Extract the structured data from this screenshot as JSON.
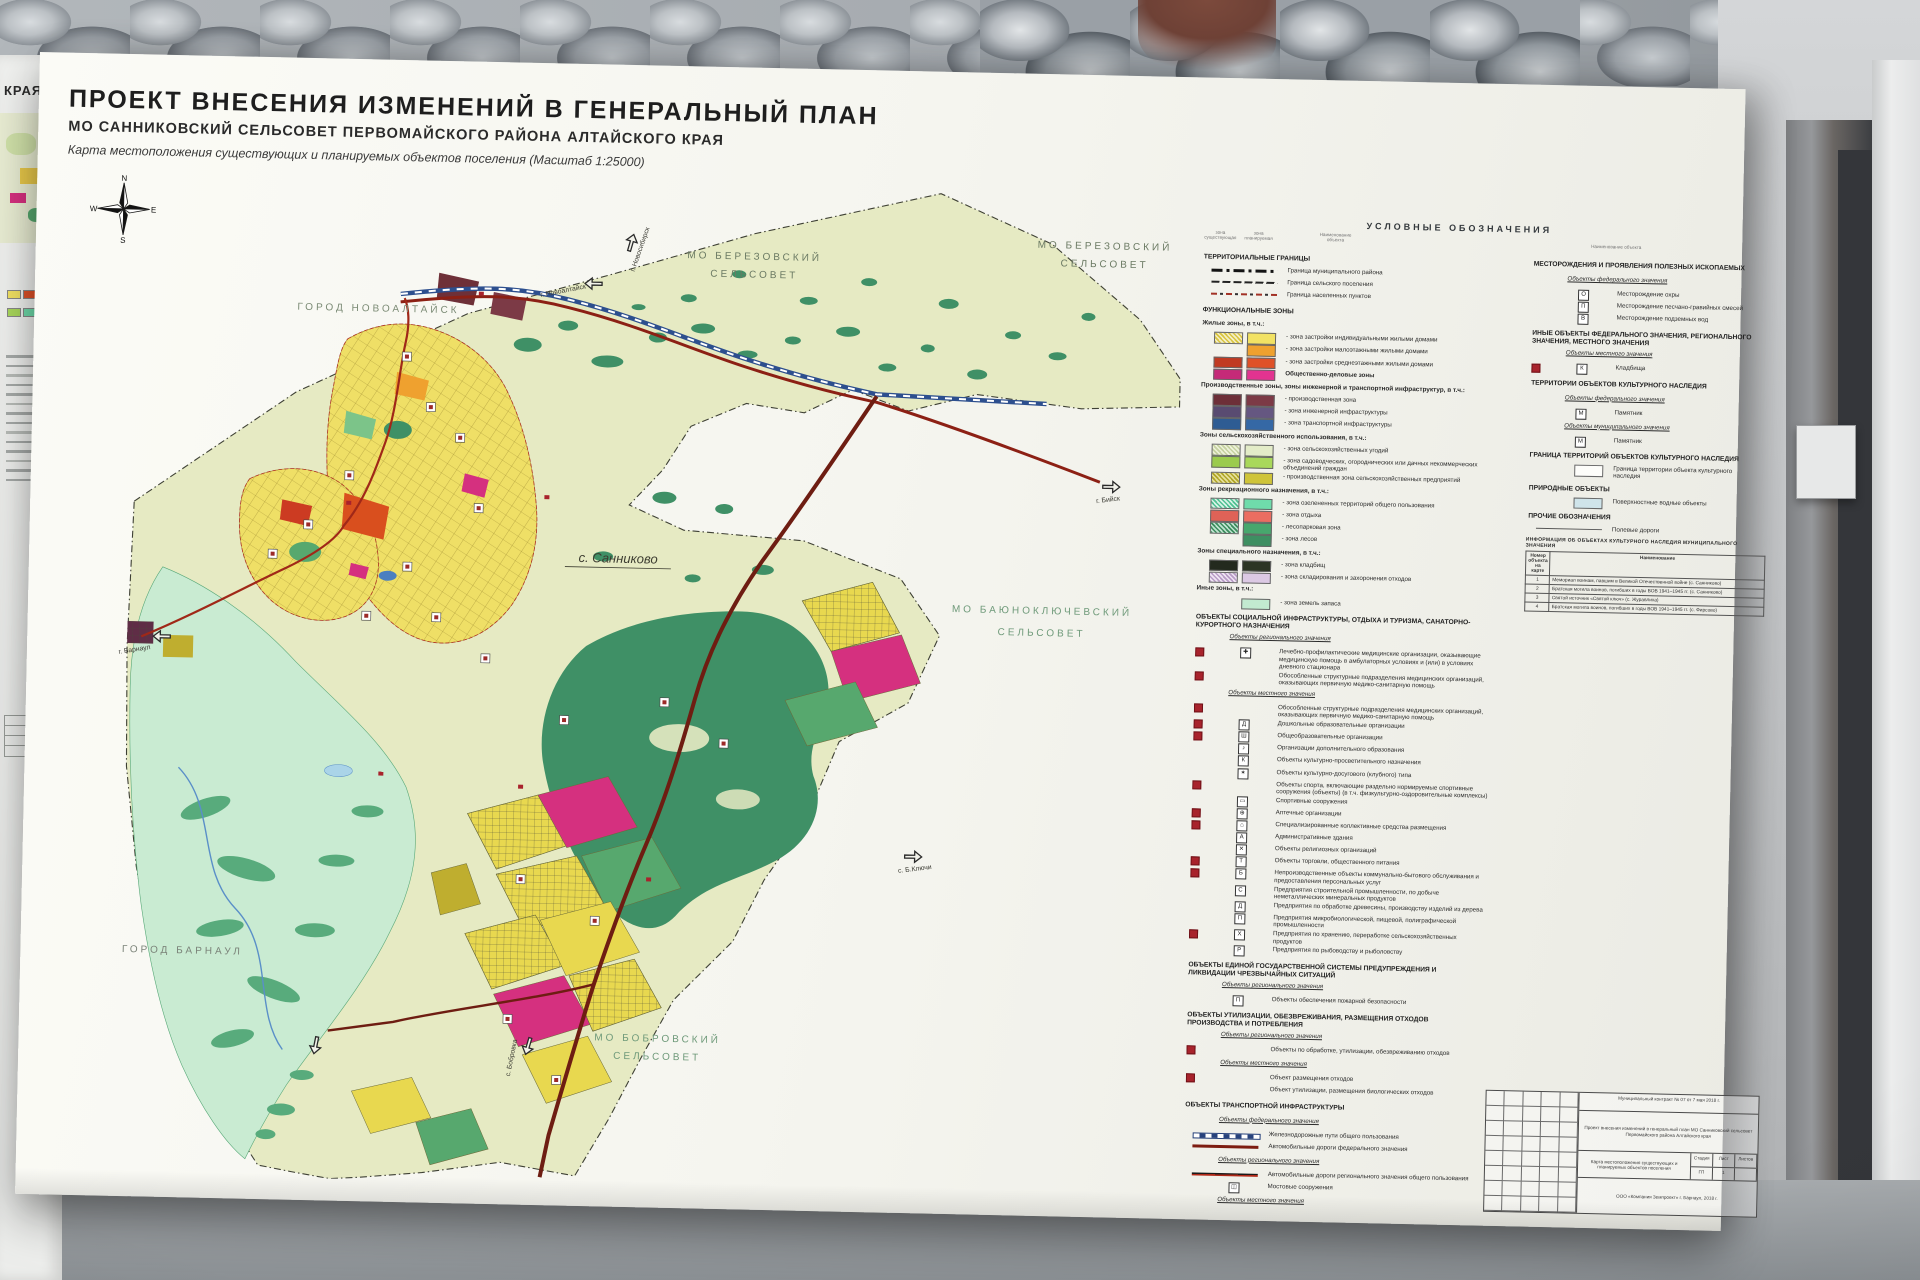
{
  "palette": {
    "paper": "#f6f6f1",
    "territory": "#e6eac3",
    "forest": "#3f9066",
    "floodplain": "#c9ebd2",
    "residential": "#efdf66",
    "public_business": "#e23390",
    "industrial": "#7c3a46",
    "fed_road": "#8c2014",
    "railway": "#2d4f8e",
    "water": "#4a7fc0",
    "planned_marker": "#a8232c"
  },
  "left_poster": {
    "fragment": "КРАЯ"
  },
  "poster": {
    "title": "ПРОЕКТ ВНЕСЕНИЯ ИЗМЕНЕНИЙ В ГЕНЕРАЛЬНЫЙ ПЛАН",
    "subtitle": "МО САННИКОВСКИЙ СЕЛЬСОВЕТ ПЕРВОМАЙСКОГО РАЙОНА АЛТАЙСКОГО КРАЯ",
    "caption": "Карта местоположения существующих и планируемых объектов поселения (Масштаб 1:25000)"
  },
  "compass": {
    "n": "N",
    "w": "W",
    "e": "E",
    "s": "S"
  },
  "map": {
    "labels": {
      "berezovsky1_l1": "МО  БЕРЕЗОВСКИЙ",
      "berezovsky1_l2": "СЕЛЬСОВЕТ",
      "berezovsky2_l1": "МО  БЕРЕЗОВСКИЙ",
      "berezovsky2_l2": "СЕЛЬСОВЕТ",
      "novoaltaysk": "ГОРОД  НОВОАЛТАЙСК",
      "sannikovo": "с. Санниково",
      "bayunokl_l1": "МО  БАЮНОКЛЮЧЕВСКИЙ",
      "bayunokl_l2": "СЕЛЬСОВЕТ",
      "barnaul": "ГОРОД  БАРНАУЛ",
      "bobrovsky_l1": "МО  БОБРОВСКИЙ",
      "bobrovsky_l2": "СЕЛЬСОВЕТ"
    },
    "arrows": {
      "novosibirsk": "г. Новосибирск",
      "novoaltaysk": "г. Новоалтайск",
      "biysk": "г. Бийск",
      "barnaul": "г. Барнаул",
      "bklyuchi": "с. Б.Ключи",
      "bobrovka": "с. Бобровка"
    }
  },
  "legend_title": "УСЛОВНЫЕ ОБОЗНАЧЕНИЯ",
  "legend_cols": {
    "existing": "зона существующая",
    "planned": "зона планируемая",
    "name": "Наименование объекта"
  },
  "legend1": {
    "rows": [
      {
        "cls": "sec",
        "label": "ТЕРРИТОРИАЛЬНЫЕ ГРАНИЦЫ"
      },
      {
        "cls": "item line b-mun",
        "label": "Граница муниципального района"
      },
      {
        "cls": "item line b-set",
        "label": "Граница сельского поселения"
      },
      {
        "cls": "item line b-nas",
        "label": "Граница населенных пунктов"
      },
      {
        "cls": "sec",
        "label": "ФУНКЦИОНАЛЬНЫЕ ЗОНЫ"
      },
      {
        "cls": "zhead",
        "label": "Жилые зоны, в т.ч.:"
      },
      {
        "cls": "item pair",
        "c1": "repeating-linear-gradient(45deg,#d8c43e 0,#d8c43e 1.6px,#f4eec6 1.6px,#f4eec6 3.2px)",
        "c2": "#f2e263",
        "label": "- зона застройки индивидуальными жилыми домами"
      },
      {
        "cls": "item pair",
        "c2": "#efa12f",
        "label": "- зона застройки малоэтажными жилыми домами"
      },
      {
        "cls": "item pair",
        "c1": "#c03a22",
        "c2": "#df5128",
        "label": "- зона застройки среднеэтажными жилыми домами"
      },
      {
        "cls": "item pair zb",
        "c1": "#c52a78",
        "c2": "#e23390",
        "label": "Общественно-деловые зоны"
      },
      {
        "cls": "zhead",
        "label": "Производственные зоны, зоны инженерной и транспортной инфраструктур, в т.ч.:"
      },
      {
        "cls": "item pair",
        "c1": "#6d2f38",
        "c2": "#7c3a46",
        "label": "- производственная зона"
      },
      {
        "cls": "item pair",
        "c1": "#594b71",
        "c2": "#655781",
        "label": "- зона инженерной инфраструктуры"
      },
      {
        "cls": "item pair",
        "c1": "#2e5c93",
        "c2": "#3568a5",
        "label": "- зона транспортной инфраструктуры"
      },
      {
        "cls": "zhead",
        "label": "Зоны сельскохозяйственного использования, в т.ч.:"
      },
      {
        "cls": "item pair",
        "c1": "repeating-linear-gradient(45deg,#c5d1a0 0,#c5d1a0 1.6px,#eef2da 1.6px,#eef2da 3.2px)",
        "c2": "#e3ecc8",
        "label": "- зона сельскохозяйственных угодий"
      },
      {
        "cls": "item pair",
        "c1": "#9bcb4d",
        "c2": "#a9d85b",
        "label": "- зона садоводческих, огороднических или дачных некоммерческих объединений граждан"
      },
      {
        "cls": "item pair",
        "c1": "repeating-linear-gradient(45deg,#b0a527 0,#b0a527 1.6px,#e6e09a 1.6px,#e6e09a 3.2px)",
        "c2": "#cfc439",
        "label": "- производственная зона сельскохозяйственных предприятий"
      },
      {
        "cls": "zhead",
        "label": "Зоны рекреационного назначения, в т.ч.:"
      },
      {
        "cls": "item pair",
        "c1": "repeating-linear-gradient(45deg,#4fc193 0,#4fc193 1.6px,#d7f3e6 1.6px,#d7f3e6 3.2px)",
        "c2": "#6fdcab",
        "label": "- зона озелененных территорий общего пользования"
      },
      {
        "cls": "item pair",
        "c1": "#df6257",
        "c2": "#eb6d61",
        "label": "- зона отдыха"
      },
      {
        "cls": "item pair",
        "c1": "repeating-linear-gradient(45deg,#3c8c5e 0,#3c8c5e 1.6px,#bfe3cf 1.6px,#bfe3cf 3.2px)",
        "c2": "#47a76d",
        "label": "- лесопарковая зона"
      },
      {
        "cls": "item pair",
        "c2": "#3e8f62",
        "label": "- зона лесов"
      },
      {
        "cls": "zhead",
        "label": "Зоны специального назначения, в т.ч.:"
      },
      {
        "cls": "item pair",
        "c1": "#232a1e",
        "c2": "#2c3524",
        "label": "- зона кладбищ"
      },
      {
        "cls": "item pair",
        "c1": "repeating-linear-gradient(45deg,#b89cc6 0,#b89cc6 1.6px,#efe4f3 1.6px,#efe4f3 3.2px)",
        "c2": "#dcc9e4",
        "label": "- зона складирования и захоронения отходов"
      },
      {
        "cls": "zhead",
        "label": "Иные зоны, в т.ч.:"
      },
      {
        "cls": "item pair",
        "c2": "#c2ead0",
        "label": "- зона земель запаса"
      },
      {
        "cls": "sec",
        "label": "ОБЪЕКТЫ СОЦИАЛЬНОЙ ИНФРАСТРУКТУРЫ, ОТДЫХА И ТУРИЗМА, САНАТОРНО-КУРОРТНОГО НАЗНАЧЕНИЯ"
      },
      {
        "cls": "sub",
        "label": "Объекты регионального значения"
      },
      {
        "cls": "item icon red",
        "icon": "✚",
        "label": "Лечебно-профилактические медицинские организации, оказывающие медицинскую помощь в амбулаторных условиях и (или) в условиях дневного стационара"
      },
      {
        "cls": "item red",
        "label": "Обособленные структурные подразделения медицинских организаций, оказывающих первичную медико-санитарную помощь"
      },
      {
        "cls": "sub",
        "label": "Объекты местного значения"
      },
      {
        "cls": "item red",
        "label": "Обособленные структурные подразделения медицинских организаций, оказывающих первичную медико-санитарную помощь"
      },
      {
        "cls": "item icon red",
        "icon": "Д",
        "label": "Дошкольные образовательные организации"
      },
      {
        "cls": "item icon red",
        "icon": "Ш",
        "label": "Общеобразовательные организации"
      },
      {
        "cls": "item icon",
        "icon": "♪",
        "label": "Организации дополнительного образования"
      },
      {
        "cls": "item icon",
        "icon": "К",
        "label": "Объекты культурно-просветительного назначения"
      },
      {
        "cls": "item icon",
        "icon": "✶",
        "label": "Объекты культурно-досугового (клубного) типа"
      },
      {
        "cls": "item red",
        "label": "Объекты спорта, включающие раздельно нормируемые спортивные сооружения (объекты) (в т.ч. физкультурно-оздоровительные комплексы)"
      },
      {
        "cls": "item icon",
        "icon": "▭",
        "label": "Спортивные сооружения"
      },
      {
        "cls": "item icon red",
        "icon": "⊕",
        "label": "Аптечные организации"
      },
      {
        "cls": "item icon red",
        "icon": "⌂",
        "label": "Специализированные коллективные средства размещения"
      },
      {
        "cls": "item icon",
        "icon": "А",
        "label": "Административные здания"
      },
      {
        "cls": "item icon",
        "icon": "✕",
        "label": "Объекты религиозных организаций"
      },
      {
        "cls": "item icon red",
        "icon": "Т",
        "label": "Объекты торговли, общественного питания"
      },
      {
        "cls": "item icon red",
        "icon": "Б",
        "label": "Непроизводственные объекты коммунально-бытового обслуживания и предоставления персональных услуг"
      },
      {
        "cls": "item icon",
        "icon": "С",
        "label": "Предприятия строительной промышленности, по добыче неметаллических минеральных продуктов"
      },
      {
        "cls": "item icon",
        "icon": "Д",
        "label": "Предприятия по обработке древесины, производству изделий из дерева"
      },
      {
        "cls": "item icon",
        "icon": "П",
        "label": "Предприятия микробиологической, пищевой, полиграфической промышленности"
      },
      {
        "cls": "item icon red",
        "icon": "Х",
        "label": "Предприятия по хранению, переработке сельскохозяйственных продуктов"
      },
      {
        "cls": "item icon",
        "icon": "Р",
        "label": "Предприятия по рыбоводству и рыболовству"
      },
      {
        "cls": "sec",
        "label": "ОБЪЕКТЫ ЕДИНОЙ ГОСУДАРСТВЕННОЙ СИСТЕМЫ ПРЕДУПРЕЖДЕНИЯ И ЛИКВИДАЦИИ ЧРЕЗВЫЧАЙНЫХ СИТУАЦИЙ"
      },
      {
        "cls": "sub",
        "label": "Объекты регионального значения"
      },
      {
        "cls": "item icon",
        "icon": "П",
        "label": "Объекты обеспечения пожарной безопасности"
      },
      {
        "cls": "sec",
        "label": "ОБЪЕКТЫ УТИЛИЗАЦИИ, ОБЕЗВРЕЖИВАНИЯ, РАЗМЕЩЕНИЯ ОТХОДОВ ПРОИЗВОДСТВА И ПОТРЕБЛЕНИЯ"
      },
      {
        "cls": "sub",
        "label": "Объекты регионального значения"
      },
      {
        "cls": "item red",
        "label": "Объекты по обработке, утилизации, обезвреживанию отходов"
      },
      {
        "cls": "sub",
        "label": "Объекты местного значения"
      },
      {
        "cls": "item red",
        "label": "Объект размещения отходов"
      },
      {
        "cls": "item",
        "label": "Объект утилизации, размещения биологических отходов"
      },
      {
        "cls": "sec",
        "label": "ОБЪЕКТЫ ТРАНСПОРТНОЙ ИНФРАСТРУКТУРЫ"
      },
      {
        "cls": "sub",
        "label": "Объекты федерального значения"
      },
      {
        "cls": "item line rail",
        "label": "Железнодорожные пути общего пользования"
      },
      {
        "cls": "item line fedroad",
        "label": "Автомобильные дороги федерального значения"
      },
      {
        "cls": "sub",
        "label": "Объекты регионального значения"
      },
      {
        "cls": "item line regroad",
        "label": "Автомобильные дороги регионального значения общего пользования"
      },
      {
        "cls": "item icon",
        "icon": "◫",
        "label": "Мостовые сооружения"
      },
      {
        "cls": "sub",
        "label": "Объекты местного значения"
      },
      {
        "cls": "item icon red",
        "icon": "В",
        "label": "Станция обезжелезивания"
      },
      {
        "cls": "item icon",
        "icon": "Т",
        "label": "Станция технического обслуживания"
      },
      {
        "cls": "item icon red",
        "icon": "С",
        "label": "Иные объекты придорожного сервиса"
      }
    ]
  },
  "legend2": {
    "rows": [
      {
        "cls": "sec",
        "label": "МЕСТОРОЖДЕНИЯ И ПРОЯВЛЕНИЯ ПОЛЕЗНЫХ ИСКОПАЕМЫХ"
      },
      {
        "cls": "sub",
        "label": "Объекты федерального значения"
      },
      {
        "cls": "item icon",
        "icon": "О",
        "label": "Месторождение охры"
      },
      {
        "cls": "item icon",
        "icon": "П",
        "label": "Месторождение песчано-гравийных смесей"
      },
      {
        "cls": "item icon",
        "icon": "В",
        "label": "Месторождение подземных вод"
      },
      {
        "cls": "sec",
        "label": "ИНЫЕ ОБЪЕКТЫ ФЕДЕРАЛЬНОГО ЗНАЧЕНИЯ, РЕГИОНАЛЬНОГО ЗНАЧЕНИЯ, МЕСТНОГО ЗНАЧЕНИЯ"
      },
      {
        "cls": "sub",
        "label": "Объекты местного значения"
      },
      {
        "cls": "item icon red",
        "icon": "К",
        "label": "Кладбища"
      },
      {
        "cls": "sec",
        "label": "ТЕРРИТОРИИ ОБЪЕКТОВ КУЛЬТУРНОГО НАСЛЕДИЯ"
      },
      {
        "cls": "sub",
        "label": "Объекты федерального значения"
      },
      {
        "cls": "item icon",
        "icon": "М",
        "label": "Памятник"
      },
      {
        "cls": "sub",
        "label": "Объекты муниципального значения"
      },
      {
        "cls": "item icon",
        "icon": "М",
        "label": "Памятник"
      },
      {
        "cls": "sec",
        "label": "ГРАНИЦА ТЕРРИТОРИЙ ОБЪЕКТОВ КУЛЬТУРНОГО НАСЛЕДИЯ"
      },
      {
        "cls": "item pair",
        "c2": "#fdfdfa",
        "label": "Граница территории объекта культурного наследия"
      },
      {
        "cls": "sec",
        "label": "ПРИРОДНЫЕ ОБЪЕКТЫ"
      },
      {
        "cls": "item pair",
        "c2": "#cfe4ea",
        "label": "Поверхностные водные объекты"
      },
      {
        "cls": "sec",
        "label": "ПРОЧИЕ ОБОЗНАЧЕНИЯ"
      },
      {
        "cls": "item line thinline",
        "label": "Полевые дороги"
      }
    ]
  },
  "heritage": {
    "title": "ИНФОРМАЦИЯ ОБ ОБЪЕКТАХ КУЛЬТУРНОГО НАСЛЕДИЯ МУНИЦИПАЛЬНОГО ЗНАЧЕНИЯ",
    "col1": "Номер объекта на карте",
    "col2": "Наименование",
    "rows": [
      {
        "n": "1",
        "name": "Мемориал воинам, павшим в Великой Отечественной войне (с. Санниково)"
      },
      {
        "n": "2",
        "name": "Братская могила воинов, погибших в годы ВОВ 1941–1945 гг. (с. Санниково)"
      },
      {
        "n": "3",
        "name": "Святой источник «Святой ключ» (с. Журавлиха)"
      },
      {
        "n": "4",
        "name": "Братская могила воинов, погибших в годы ВОВ 1941–1945 гг. (с. Фирсово)"
      }
    ]
  },
  "stamp": {
    "row1": "Муниципальный контракт № 07 от 7 мая 2018 г.",
    "row2": "Проект внесения изменений в генеральный план МО Санниковский сельсовет Первомайского района Алтайского края",
    "map_name": "Карта местоположения существующих и планируемых объектов поселения",
    "stage_label": "Стадия",
    "sheet_label": "Лист",
    "sheets_label": "Листов",
    "stage": "ГП",
    "sheet": "1",
    "org": "ООО «Компания Земпроект» г. Барнаул, 2018 г."
  }
}
